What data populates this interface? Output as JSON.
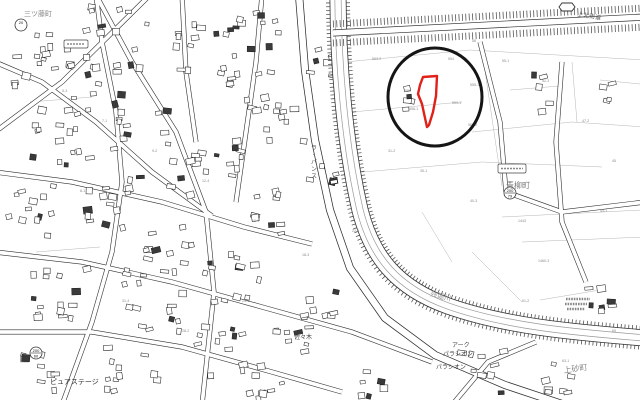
{
  "map": {
    "kind": "cadastral-city-planning-map",
    "background": "#ffffff",
    "annotation": {
      "circle": {
        "cx": 435,
        "cy": 97,
        "rx": 47,
        "ry": 49,
        "stroke": "#151515",
        "width": 3
      },
      "parcel": {
        "stroke": "#e02019",
        "width": 2.4,
        "points": [
          [
            423,
            77
          ],
          [
            437,
            76
          ],
          [
            436,
            96
          ],
          [
            433,
            112
          ],
          [
            429,
            125
          ],
          [
            427,
            127
          ],
          [
            425,
            118
          ],
          [
            422,
            104
          ],
          [
            418,
            94
          ],
          [
            420,
            85
          ]
        ]
      }
    },
    "place_labels": [
      {
        "name": "town-label-mitsufuji",
        "t": "三ツ藤町",
        "x": 24,
        "y": 16,
        "s": 7,
        "c": "#8a8a8a",
        "r": 0
      },
      {
        "name": "town-label-aoyagicho",
        "t": "青柳町",
        "x": 506,
        "y": 188,
        "s": 8,
        "c": "#777777",
        "r": 0
      },
      {
        "name": "town-label-kamisunacho",
        "t": "上砂町",
        "x": 564,
        "y": 373,
        "s": 8,
        "c": "#888888",
        "r": -8
      },
      {
        "name": "river-label-zanborigawa",
        "t": "残堀川",
        "x": 430,
        "y": 296,
        "s": 7,
        "c": "#999999",
        "r": 14
      },
      {
        "name": "road-label-kamikita-kaido",
        "t": "上北街道",
        "x": 577,
        "y": 16,
        "s": 6,
        "c": "#555555",
        "r": 9
      },
      {
        "name": "building-label-pure-stage",
        "t": "ピュアステージ",
        "x": 50,
        "y": 384,
        "s": 7,
        "c": "#333333",
        "r": 0
      },
      {
        "name": "building-label-ark",
        "t": "アーク",
        "x": 452,
        "y": 347,
        "s": 6,
        "c": "#444444",
        "r": 0
      },
      {
        "name": "building-label-palacion",
        "t": "パラシオン",
        "x": 443,
        "y": 356,
        "s": 6,
        "c": "#444444",
        "r": 0
      },
      {
        "name": "building-label-palacion-2",
        "t": "パラシオン",
        "x": 436,
        "y": 369,
        "s": 6,
        "c": "#444444",
        "r": 0
      },
      {
        "name": "label-sasaki",
        "t": "佐々木",
        "x": 294,
        "y": 339,
        "s": 6,
        "c": "#444444",
        "r": 0
      },
      {
        "name": "building-label-la-vance",
        "t": "ラ・バンス",
        "x": 311,
        "y": 150,
        "s": 6,
        "c": "#555555",
        "vertical": true
      }
    ],
    "survey_badges": [
      {
        "name": "survey-point-200-79",
        "cx": 510,
        "cy": 193,
        "top": "200",
        "bottom": "79",
        "double": true
      },
      {
        "name": "survey-point-200-60",
        "cx": 36,
        "cy": 353,
        "top": "200",
        "bottom": "60",
        "double": true
      },
      {
        "name": "route-badge-20",
        "cx": 21,
        "cy": 25,
        "top": "20",
        "bottom": "",
        "double": false
      }
    ],
    "route_shield": {
      "cx": 570,
      "cy": 7
    },
    "label_boxes": [
      {
        "x": 498,
        "y": 164,
        "w": 28,
        "h": 9
      },
      {
        "x": 64,
        "y": 40,
        "w": 24,
        "h": 8
      }
    ],
    "faux_text_lines": [
      {
        "x": 566,
        "y": 299,
        "w": 24
      },
      {
        "x": 565,
        "y": 304,
        "w": 22
      },
      {
        "x": 567,
        "y": 309,
        "w": 18
      }
    ],
    "parcel_numbers": [
      {
        "t": "553-2",
        "x": 372,
        "y": 60
      },
      {
        "t": "554",
        "x": 448,
        "y": 60
      },
      {
        "t": "555-1",
        "x": 470,
        "y": 86
      },
      {
        "t": "556",
        "x": 405,
        "y": 92
      },
      {
        "t": "558-1",
        "x": 409,
        "y": 110
      },
      {
        "t": "553-1",
        "x": 452,
        "y": 104
      },
      {
        "t": "560-2",
        "x": 468,
        "y": 126
      },
      {
        "t": "31-2",
        "x": 388,
        "y": 152
      },
      {
        "t": "35-1",
        "x": 420,
        "y": 172
      },
      {
        "t": "40-3",
        "x": 470,
        "y": 202
      },
      {
        "t": "43-1",
        "x": 600,
        "y": 212
      },
      {
        "t": "45",
        "x": 612,
        "y": 162
      },
      {
        "t": "47-2",
        "x": 582,
        "y": 122
      },
      {
        "t": "52-3",
        "x": 542,
        "y": 82
      },
      {
        "t": "55-1",
        "x": 502,
        "y": 62
      },
      {
        "t": "58",
        "x": 472,
        "y": 42
      },
      {
        "t": "22-5",
        "x": 352,
        "y": 232
      },
      {
        "t": "18-3",
        "x": 302,
        "y": 256
      },
      {
        "t": "15-1",
        "x": 252,
        "y": 222
      },
      {
        "t": "12-4",
        "x": 202,
        "y": 182
      },
      {
        "t": "9-2",
        "x": 152,
        "y": 152
      },
      {
        "t": "7-1",
        "x": 102,
        "y": 122
      },
      {
        "t": "5-3",
        "x": 62,
        "y": 92
      },
      {
        "t": "25-1",
        "x": 242,
        "y": 302
      },
      {
        "t": "28-2",
        "x": 182,
        "y": 332
      },
      {
        "t": "31-4",
        "x": 122,
        "y": 302
      },
      {
        "t": "61-2",
        "x": 522,
        "y": 302
      },
      {
        "t": "63-1",
        "x": 562,
        "y": 362
      },
      {
        "t": "65",
        "x": 612,
        "y": 332
      },
      {
        "t": "1443",
        "x": 518,
        "y": 222
      },
      {
        "t": "1460-3",
        "x": 538,
        "y": 262
      },
      {
        "t": "8-1",
        "x": 80,
        "y": 192
      }
    ],
    "river_path": "M338,-5 C338,60 344,140 360,210 C372,258 398,288 448,306 C505,326 570,332 645,338",
    "highway": {
      "comb_top": "M333,24 L645,8",
      "road": "M333,33 L645,17",
      "comb_bottom": "M333,43 L645,27"
    },
    "main_roads": [
      "M299,-5 L305,70 L315,140 L330,210 L350,268 L385,318 L435,355 L505,385 L565,405"
    ],
    "minor_roads": [
      "M150,-5 L62,82 L-5,132",
      "M96,-5 L132,62 L176,132 L206,212 L214,292 L202,405",
      "M-5,62 L42,82 L96,122 L152,172 L212,216",
      "M-5,172 L72,182 L162,202 L244,227 L312,244",
      "M-5,252 L82,262 L172,282 L262,307 L352,332 L432,362",
      "M-5,332 L92,332 L182,347 L272,372 L342,392",
      "M62,405 L92,322 L112,252 L122,182 L116,112 L102,42 L96,-5",
      "M262,-5 L256,62 L246,132 L236,202",
      "M182,-5 L186,72 L196,142",
      "M480,42 L500,122 L506,192",
      "M562,62 L556,142 L562,222 L586,282",
      "M645,202 L562,212 L506,192",
      "M452,405 L488,362 L536,342"
    ],
    "parcel_lines": [
      "M345,62 L470,50 L645,60",
      "M352,112 L462,102",
      "M472,132 L572,122 L645,127",
      "M482,50 L494,132 L502,186",
      "M572,62 L577,122",
      "M362,172 L482,162 L602,167",
      "M502,217 L642,210",
      "M522,242 L645,237",
      "M472,252 L522,302",
      "M422,212 L452,262",
      "M30,102 L92,97",
      "M36,252 L100,247",
      "M540,300 L600,290",
      "M380,250 L420,290",
      "M600,80 L640,84",
      "M510,90 L560,86"
    ]
  }
}
